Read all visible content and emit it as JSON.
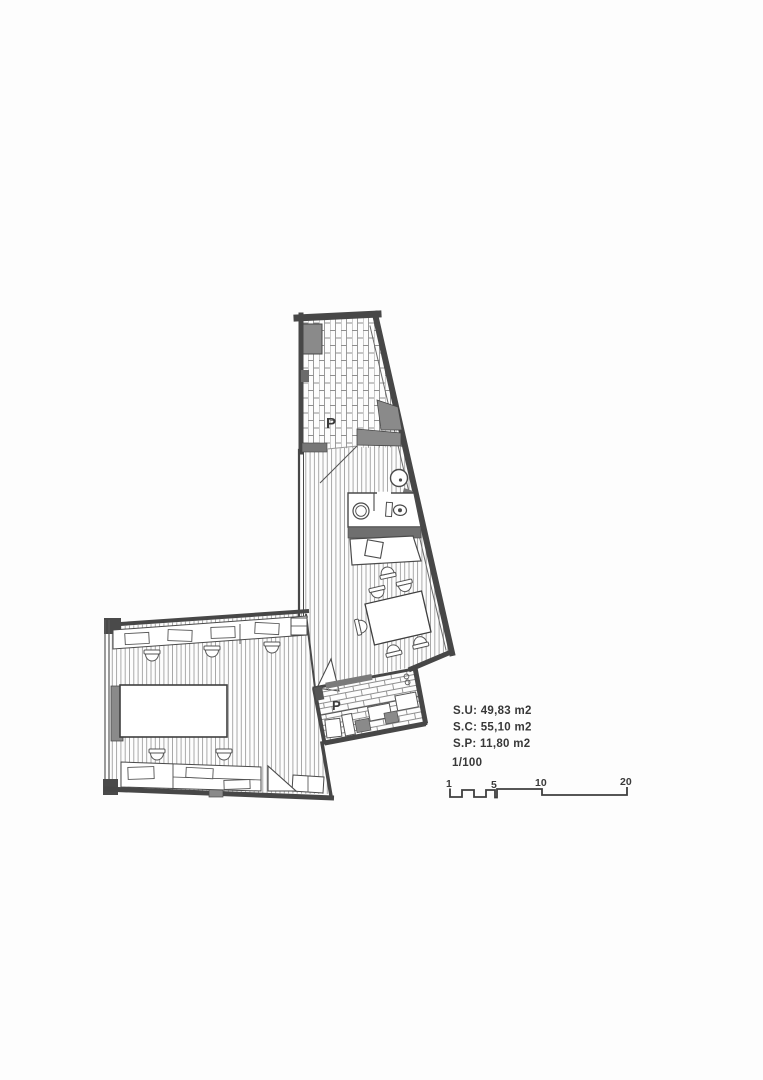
{
  "document": {
    "kind": "scanned architectural floor plan"
  },
  "plan": {
    "labels": {
      "patio_top": "P",
      "patio_bottom": "P"
    }
  },
  "annotations": {
    "surface_useful": "S.U: 49,83 m2",
    "surface_constructed": "S.C: 55,10 m2",
    "surface_terrace": "S.P: 11,80 m2",
    "scale": "1/100"
  },
  "scale_bar": {
    "ticks": [
      "1",
      "5",
      "10",
      "20"
    ]
  },
  "colors": {
    "paper": "#fdfdfd",
    "ink": "#3e3e3e",
    "wall_dark": "#474747",
    "column_gray": "#8a8a8a",
    "band_gray": "#777777",
    "floor_hatch": "#a0a0a0",
    "brick_hatch": "#8f8f8f"
  }
}
